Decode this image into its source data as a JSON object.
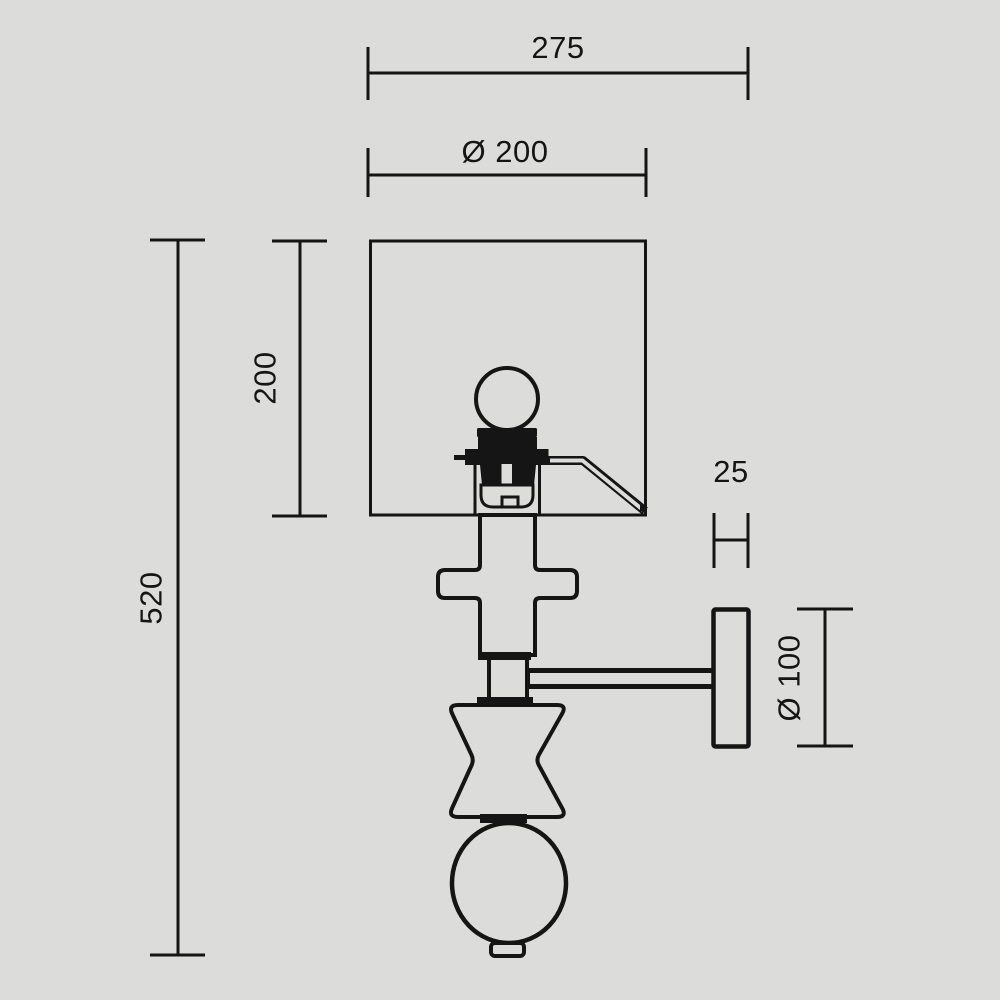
{
  "title": "wall-lamp-technical-dimension-drawing",
  "colors": {
    "background": "#dcdcda",
    "line": "#151515"
  },
  "dimensions": {
    "overall_depth": {
      "label": "275"
    },
    "shade_diameter": {
      "label": "Ø 200"
    },
    "shade_height": {
      "label": "200"
    },
    "overall_height": {
      "label": "520"
    },
    "wall_plate_thickness": {
      "label": "25"
    },
    "wall_plate_diameter": {
      "label": "Ø 100"
    }
  }
}
